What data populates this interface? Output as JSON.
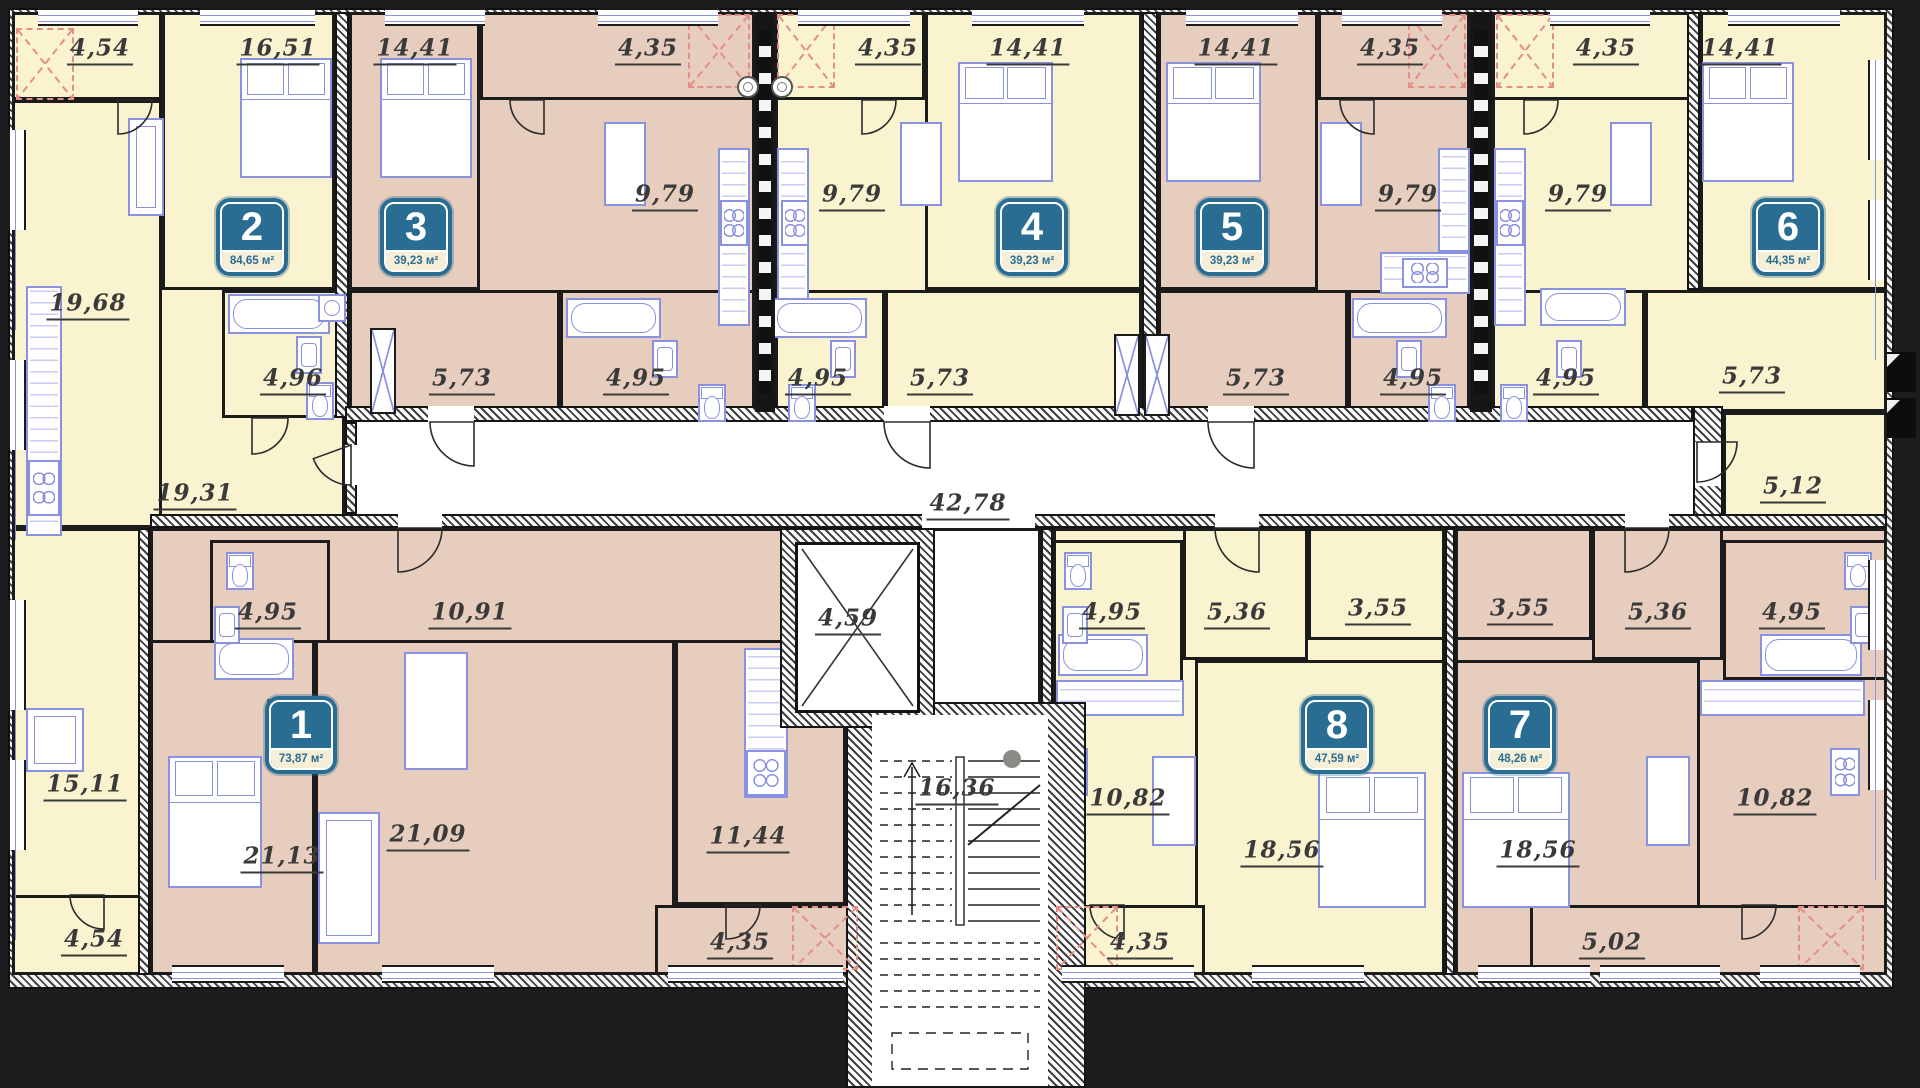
{
  "title": "Residential floor plan, 8 apartments",
  "palette": {
    "yellow": "#faf3cf",
    "pink": "#e7cdbe",
    "white": "#ffffff",
    "badge_teal": "#2a6d92",
    "badge_strip": "#f6efd7",
    "label_ink": "#3a3a3a",
    "furniture_blue": "#8a92e0",
    "balcony_red": "#e29087",
    "background": "#1d1d1f"
  },
  "units_suffix": "м²",
  "apartments": [
    {
      "n": "1",
      "area": "73,87 м²",
      "cx": 301,
      "cy": 735
    },
    {
      "n": "2",
      "area": "84,65 м²",
      "cx": 252,
      "cy": 237
    },
    {
      "n": "3",
      "area": "39,23 м²",
      "cx": 416,
      "cy": 237
    },
    {
      "n": "4",
      "area": "39,23 м²",
      "cx": 1032,
      "cy": 237
    },
    {
      "n": "5",
      "area": "39,23 м²",
      "cx": 1232,
      "cy": 237
    },
    {
      "n": "6",
      "area": "44,35 м²",
      "cx": 1788,
      "cy": 237
    },
    {
      "n": "7",
      "area": "48,26 м²",
      "cx": 1520,
      "cy": 735
    },
    {
      "n": "8",
      "area": "47,59 м²",
      "cx": 1337,
      "cy": 735
    }
  ],
  "structure": {
    "footprint": {
      "x": 8,
      "y": 8,
      "w": 1886,
      "h": 981
    },
    "interior": {
      "x": 24,
      "y": 24,
      "w": 1854,
      "h": 951
    },
    "stair_tower": {
      "x": 846,
      "y": 702,
      "w": 240,
      "h": 386
    },
    "stair_inner": {
      "x": 872,
      "y": 715,
      "w": 176,
      "h": 371
    },
    "elevator": {
      "label": "4,59",
      "x": 795,
      "y": 528,
      "w": 125,
      "h": 185,
      "lx": 848,
      "ly": 620
    },
    "stairs_label": {
      "text": "16,36",
      "lx": 957,
      "ly": 790
    },
    "corridor_label": {
      "text": "42,78",
      "lx": 968,
      "ly": 505
    }
  },
  "rooms": [
    {
      "f": "y",
      "x": 12,
      "y": 12,
      "w": 333,
      "h": 516
    },
    {
      "f": "y",
      "x": 12,
      "y": 12,
      "w": 150,
      "h": 88,
      "label": "4,54",
      "lx": 100,
      "ly": 50
    },
    {
      "f": "y",
      "x": 12,
      "y": 100,
      "w": 150,
      "h": 428,
      "label": "19,68",
      "lx": 88,
      "ly": 305
    },
    {
      "f": "y",
      "x": 162,
      "y": 12,
      "w": 173,
      "h": 278,
      "label": "16,51",
      "lx": 278,
      "ly": 50
    },
    {
      "f": "y",
      "x": 222,
      "y": 290,
      "w": 123,
      "h": 128,
      "label": "4,96",
      "lx": 293,
      "ly": 380
    },
    {
      "label": "19,31",
      "lx": 195,
      "ly": 495
    },
    {
      "f": "p",
      "x": 349,
      "y": 12,
      "w": 406,
      "h": 408
    },
    {
      "f": "p",
      "x": 349,
      "y": 12,
      "w": 131,
      "h": 278,
      "label": "14,41",
      "lx": 415,
      "ly": 50
    },
    {
      "f": "p",
      "x": 480,
      "y": 12,
      "w": 275,
      "h": 88,
      "label": "4,35",
      "lx": 648,
      "ly": 50
    },
    {
      "label": "9,79",
      "lx": 665,
      "ly": 196
    },
    {
      "f": "p",
      "x": 349,
      "y": 290,
      "w": 211,
      "h": 128,
      "label": "5,73",
      "lx": 462,
      "ly": 380
    },
    {
      "f": "p",
      "x": 560,
      "y": 290,
      "w": 195,
      "h": 128,
      "label": "4,95",
      "lx": 636,
      "ly": 380
    },
    {
      "f": "y",
      "x": 775,
      "y": 12,
      "w": 367,
      "h": 408
    },
    {
      "f": "y",
      "x": 775,
      "y": 12,
      "w": 150,
      "h": 88,
      "label": "4,35",
      "lx": 888,
      "ly": 50
    },
    {
      "f": "y",
      "x": 925,
      "y": 12,
      "w": 217,
      "h": 278,
      "label": "14,41",
      "lx": 1028,
      "ly": 50
    },
    {
      "label": "9,79",
      "lx": 852,
      "ly": 196
    },
    {
      "f": "y",
      "x": 775,
      "y": 290,
      "w": 110,
      "h": 128,
      "label": "4,95",
      "lx": 818,
      "ly": 380
    },
    {
      "f": "y",
      "x": 885,
      "y": 290,
      "w": 257,
      "h": 128,
      "label": "5,73",
      "lx": 940,
      "ly": 380
    },
    {
      "f": "p",
      "x": 1158,
      "y": 12,
      "w": 312,
      "h": 408
    },
    {
      "f": "p",
      "x": 1158,
      "y": 12,
      "w": 160,
      "h": 278,
      "label": "14,41",
      "lx": 1236,
      "ly": 50
    },
    {
      "f": "p",
      "x": 1318,
      "y": 12,
      "w": 152,
      "h": 88,
      "label": "4,35",
      "lx": 1390,
      "ly": 50
    },
    {
      "label": "9,79",
      "lx": 1408,
      "ly": 196
    },
    {
      "f": "p",
      "x": 1158,
      "y": 290,
      "w": 190,
      "h": 128,
      "label": "5,73",
      "lx": 1256,
      "ly": 380
    },
    {
      "f": "p",
      "x": 1348,
      "y": 290,
      "w": 122,
      "h": 128,
      "label": "4,95",
      "lx": 1413,
      "ly": 380
    },
    {
      "f": "y",
      "x": 1492,
      "y": 12,
      "w": 395,
      "h": 408
    },
    {
      "f": "y",
      "x": 1492,
      "y": 12,
      "w": 208,
      "h": 88,
      "label": "4,35",
      "lx": 1606,
      "ly": 50
    },
    {
      "f": "y",
      "x": 1700,
      "y": 12,
      "w": 187,
      "h": 278,
      "label": "14,41",
      "lx": 1740,
      "ly": 50
    },
    {
      "label": "9,79",
      "lx": 1578,
      "ly": 196
    },
    {
      "f": "y",
      "x": 1492,
      "y": 290,
      "w": 153,
      "h": 128,
      "label": "4,95",
      "lx": 1566,
      "ly": 380
    },
    {
      "f": "y",
      "x": 1645,
      "y": 290,
      "w": 242,
      "h": 122,
      "label": "5,73",
      "lx": 1752,
      "ly": 378
    },
    {
      "f": "y",
      "x": 1723,
      "y": 412,
      "w": 164,
      "h": 116,
      "label": "5,12",
      "lx": 1793,
      "ly": 488
    },
    {
      "f": "y",
      "x": 12,
      "y": 528,
      "w": 138,
      "h": 447
    },
    {
      "label": "15,11",
      "lx": 85,
      "ly": 786
    },
    {
      "f": "y",
      "x": 12,
      "y": 895,
      "w": 138,
      "h": 80,
      "label": "4,54",
      "lx": 94,
      "ly": 941
    },
    {
      "f": "p",
      "x": 150,
      "y": 528,
      "w": 696,
      "h": 447
    },
    {
      "f": "p",
      "x": 210,
      "y": 540,
      "w": 120,
      "h": 160,
      "label": "4,95",
      "lx": 268,
      "ly": 614
    },
    {
      "label": "10,91",
      "lx": 470,
      "ly": 614
    },
    {
      "f": "p",
      "x": 150,
      "y": 640,
      "w": 165,
      "h": 335,
      "label": "21,13",
      "lx": 282,
      "ly": 858
    },
    {
      "f": "p",
      "x": 315,
      "y": 640,
      "w": 360,
      "h": 335,
      "label": "21,09",
      "lx": 428,
      "ly": 836
    },
    {
      "f": "p",
      "x": 675,
      "y": 640,
      "w": 171,
      "h": 265,
      "label": "11,44",
      "lx": 748,
      "ly": 838
    },
    {
      "f": "p",
      "x": 655,
      "y": 905,
      "w": 205,
      "h": 70,
      "label": "4,35",
      "lx": 740,
      "ly": 944
    },
    {
      "f": "y",
      "x": 1053,
      "y": 528,
      "w": 392,
      "h": 447
    },
    {
      "f": "y",
      "x": 1053,
      "y": 540,
      "w": 130,
      "h": 160,
      "label": "4,95",
      "lx": 1112,
      "ly": 614
    },
    {
      "f": "y",
      "x": 1183,
      "y": 528,
      "w": 125,
      "h": 132,
      "label": "5,36",
      "lx": 1237,
      "ly": 614
    },
    {
      "f": "y",
      "x": 1308,
      "y": 528,
      "w": 137,
      "h": 112,
      "label": "3,55",
      "lx": 1378,
      "ly": 610
    },
    {
      "label": "10,82",
      "lx": 1128,
      "ly": 800
    },
    {
      "f": "y",
      "x": 1195,
      "y": 660,
      "w": 250,
      "h": 315,
      "label": "18,56",
      "lx": 1282,
      "ly": 852
    },
    {
      "f": "y",
      "x": 1053,
      "y": 905,
      "w": 152,
      "h": 70,
      "label": "4,35",
      "lx": 1140,
      "ly": 944
    },
    {
      "f": "p",
      "x": 1455,
      "y": 528,
      "w": 432,
      "h": 447
    },
    {
      "f": "p",
      "x": 1455,
      "y": 528,
      "w": 137,
      "h": 112,
      "label": "3,55",
      "lx": 1520,
      "ly": 610
    },
    {
      "f": "p",
      "x": 1592,
      "y": 528,
      "w": 131,
      "h": 132,
      "label": "5,36",
      "lx": 1658,
      "ly": 614
    },
    {
      "f": "p",
      "x": 1723,
      "y": 540,
      "w": 164,
      "h": 140,
      "label": "4,95",
      "lx": 1792,
      "ly": 614
    },
    {
      "label": "10,82",
      "lx": 1775,
      "ly": 800
    },
    {
      "f": "p",
      "x": 1455,
      "y": 660,
      "w": 245,
      "h": 315,
      "label": "18,56",
      "lx": 1538,
      "ly": 852
    },
    {
      "f": "p",
      "x": 1530,
      "y": 905,
      "w": 357,
      "h": 70,
      "label": "5,02",
      "lx": 1612,
      "ly": 944
    },
    {
      "f": "w",
      "x": 920,
      "y": 528,
      "w": 121,
      "h": 190
    }
  ],
  "walls": [
    {
      "x": 335,
      "y": 12,
      "w": 14,
      "h": 406
    },
    {
      "x": 1142,
      "y": 12,
      "w": 16,
      "h": 406
    },
    {
      "x": 1687,
      "y": 12,
      "w": 13,
      "h": 278
    },
    {
      "x": 345,
      "y": 406,
      "w": 1348,
      "h": 16
    },
    {
      "x": 1693,
      "y": 406,
      "w": 30,
      "h": 122
    },
    {
      "x": 345,
      "y": 422,
      "w": 12,
      "h": 92
    },
    {
      "x": 150,
      "y": 514,
      "w": 1737,
      "h": 14
    },
    {
      "x": 138,
      "y": 528,
      "w": 12,
      "h": 447
    },
    {
      "x": 1041,
      "y": 528,
      "w": 12,
      "h": 447
    },
    {
      "x": 1445,
      "y": 528,
      "w": 10,
      "h": 447
    }
  ],
  "gaps": [
    {
      "x": 428,
      "y": 406,
      "w": 46,
      "h": 16
    },
    {
      "x": 884,
      "y": 406,
      "w": 46,
      "h": 16
    },
    {
      "x": 1208,
      "y": 406,
      "w": 46,
      "h": 16
    },
    {
      "x": 1695,
      "y": 442,
      "w": 26,
      "h": 44
    },
    {
      "x": 398,
      "y": 514,
      "w": 44,
      "h": 14
    },
    {
      "x": 1215,
      "y": 514,
      "w": 44,
      "h": 14
    },
    {
      "x": 1625,
      "y": 514,
      "w": 44,
      "h": 14
    },
    {
      "x": 922,
      "y": 514,
      "w": 113,
      "h": 14
    },
    {
      "x": 920,
      "y": 700,
      "w": 115,
      "h": 17
    },
    {
      "x": 345,
      "y": 445,
      "w": 12,
      "h": 40
    }
  ],
  "shafts": [
    {
      "x": 755,
      "y": 12,
      "w": 20,
      "h": 400
    },
    {
      "x": 1470,
      "y": 12,
      "w": 22,
      "h": 400
    }
  ],
  "vents": [
    {
      "x": 737,
      "y": 76
    },
    {
      "x": 771,
      "y": 76
    }
  ],
  "redboxes": [
    {
      "x": 16,
      "y": 28,
      "w": 58,
      "h": 72
    },
    {
      "x": 688,
      "y": 14,
      "w": 62,
      "h": 74
    },
    {
      "x": 777,
      "y": 14,
      "w": 58,
      "h": 74
    },
    {
      "x": 1408,
      "y": 14,
      "w": 58,
      "h": 74
    },
    {
      "x": 1496,
      "y": 14,
      "w": 58,
      "h": 74
    },
    {
      "x": 792,
      "y": 906,
      "w": 66,
      "h": 64
    },
    {
      "x": 1056,
      "y": 906,
      "w": 62,
      "h": 64
    },
    {
      "x": 1798,
      "y": 906,
      "w": 66,
      "h": 64
    }
  ],
  "windows_top": [
    {
      "x": 38,
      "w": 100
    },
    {
      "x": 200,
      "w": 115
    },
    {
      "x": 385,
      "w": 100
    },
    {
      "x": 598,
      "w": 120
    },
    {
      "x": 798,
      "w": 112
    },
    {
      "x": 972,
      "w": 112
    },
    {
      "x": 1186,
      "w": 112
    },
    {
      "x": 1342,
      "w": 100
    },
    {
      "x": 1550,
      "w": 100
    },
    {
      "x": 1728,
      "w": 112
    }
  ],
  "windows_bottom": [
    {
      "x": 172,
      "w": 112
    },
    {
      "x": 382,
      "w": 112
    },
    {
      "x": 668,
      "w": 175
    },
    {
      "x": 1062,
      "w": 132
    },
    {
      "x": 1252,
      "w": 112
    },
    {
      "x": 1478,
      "w": 112
    },
    {
      "x": 1600,
      "w": 120
    },
    {
      "x": 1760,
      "w": 100
    }
  ],
  "windows_left": [
    {
      "y": 130,
      "h": 100
    },
    {
      "y": 360,
      "h": 90
    },
    {
      "y": 600,
      "h": 110
    },
    {
      "y": 760,
      "h": 90
    }
  ],
  "windows_right": [
    {
      "y": 60,
      "h": 100
    },
    {
      "y": 200,
      "h": 80
    },
    {
      "y": 560,
      "h": 90
    },
    {
      "y": 700,
      "h": 90
    }
  ],
  "steps": [
    {
      "x": 1882,
      "y": 352
    },
    {
      "x": 1882,
      "y": 398
    }
  ],
  "xpanels": [
    {
      "x": 370,
      "y": 328,
      "w": 26,
      "h": 86
    },
    {
      "x": 1114,
      "y": 334,
      "w": 26,
      "h": 82
    },
    {
      "x": 1144,
      "y": 334,
      "w": 26,
      "h": 82
    }
  ],
  "furniture": {
    "beds": [
      {
        "x": 240,
        "y": 58,
        "w": 92,
        "h": 120
      },
      {
        "x": 380,
        "y": 58,
        "w": 92,
        "h": 120
      },
      {
        "x": 958,
        "y": 62,
        "w": 95,
        "h": 120
      },
      {
        "x": 1166,
        "y": 62,
        "w": 95,
        "h": 120
      },
      {
        "x": 1702,
        "y": 62,
        "w": 92,
        "h": 120
      },
      {
        "x": 168,
        "y": 756,
        "w": 94,
        "h": 132
      },
      {
        "x": 1318,
        "y": 772,
        "w": 108,
        "h": 136
      },
      {
        "x": 1462,
        "y": 772,
        "w": 108,
        "h": 136
      }
    ],
    "tubs": [
      {
        "x": 228,
        "y": 294,
        "w": 102,
        "h": 40
      },
      {
        "x": 566,
        "y": 298,
        "w": 95,
        "h": 40
      },
      {
        "x": 772,
        "y": 298,
        "w": 95,
        "h": 40
      },
      {
        "x": 1352,
        "y": 298,
        "w": 95,
        "h": 40
      },
      {
        "x": 1540,
        "y": 288,
        "w": 86,
        "h": 38
      },
      {
        "x": 214,
        "y": 638,
        "w": 80,
        "h": 42
      },
      {
        "x": 1058,
        "y": 634,
        "w": 90,
        "h": 42
      },
      {
        "x": 1760,
        "y": 634,
        "w": 102,
        "h": 42
      }
    ],
    "toilets": [
      {
        "x": 306,
        "y": 382
      },
      {
        "x": 698,
        "y": 384
      },
      {
        "x": 788,
        "y": 384
      },
      {
        "x": 1428,
        "y": 384
      },
      {
        "x": 1500,
        "y": 384
      },
      {
        "x": 226,
        "y": 552
      },
      {
        "x": 1064,
        "y": 552
      },
      {
        "x": 1844,
        "y": 552
      }
    ],
    "sinks": [
      {
        "x": 296,
        "y": 336
      },
      {
        "x": 652,
        "y": 340
      },
      {
        "x": 830,
        "y": 340
      },
      {
        "x": 1396,
        "y": 340
      },
      {
        "x": 1556,
        "y": 340
      },
      {
        "x": 214,
        "y": 606
      },
      {
        "x": 1062,
        "y": 606
      },
      {
        "x": 1850,
        "y": 606
      }
    ],
    "tables": [
      {
        "x": 604,
        "y": 122,
        "w": 42,
        "h": 84
      },
      {
        "x": 900,
        "y": 122,
        "w": 42,
        "h": 84
      },
      {
        "x": 1320,
        "y": 122,
        "w": 42,
        "h": 84
      },
      {
        "x": 1610,
        "y": 122,
        "w": 42,
        "h": 84
      },
      {
        "x": 404,
        "y": 652,
        "w": 64,
        "h": 118
      },
      {
        "x": 1152,
        "y": 756,
        "w": 44,
        "h": 90
      },
      {
        "x": 1646,
        "y": 756,
        "w": 44,
        "h": 90
      }
    ],
    "sofas": [
      {
        "x": 128,
        "y": 118,
        "w": 36,
        "h": 98
      },
      {
        "x": 318,
        "y": 812,
        "w": 62,
        "h": 132
      }
    ],
    "desks": [
      {
        "x": 26,
        "y": 708,
        "w": 58,
        "h": 64
      }
    ],
    "counters": [
      {
        "x": 26,
        "y": 286,
        "w": 36,
        "h": 250
      },
      {
        "x": 718,
        "y": 148,
        "w": 32,
        "h": 178
      },
      {
        "x": 777,
        "y": 148,
        "w": 32,
        "h": 178
      },
      {
        "x": 1380,
        "y": 252,
        "w": 90,
        "h": 42
      },
      {
        "x": 1438,
        "y": 148,
        "w": 32,
        "h": 104
      },
      {
        "x": 1494,
        "y": 148,
        "w": 32,
        "h": 178
      },
      {
        "x": 744,
        "y": 648,
        "w": 44,
        "h": 150
      },
      {
        "x": 1056,
        "y": 680,
        "w": 128,
        "h": 36
      },
      {
        "x": 1700,
        "y": 680,
        "w": 165,
        "h": 36
      }
    ],
    "stoves": [
      {
        "x": 720,
        "y": 200,
        "w": 28,
        "h": 46
      },
      {
        "x": 781,
        "y": 200,
        "w": 28,
        "h": 46
      },
      {
        "x": 1402,
        "y": 258,
        "w": 46,
        "h": 30
      },
      {
        "x": 1496,
        "y": 200,
        "w": 28,
        "h": 46
      },
      {
        "x": 28,
        "y": 460,
        "w": 32,
        "h": 56
      },
      {
        "x": 746,
        "y": 750,
        "w": 40,
        "h": 46
      },
      {
        "x": 1058,
        "y": 748,
        "w": 30,
        "h": 48
      },
      {
        "x": 1830,
        "y": 748,
        "w": 30,
        "h": 48
      }
    ],
    "washers": [
      {
        "x": 318,
        "y": 294,
        "w": 28,
        "h": 28
      }
    ]
  },
  "doors": [
    {
      "hx": 474,
      "hy": 422,
      "r": 44,
      "a0": 90,
      "a1": 180
    },
    {
      "hx": 930,
      "hy": 422,
      "r": 46,
      "a0": 90,
      "a1": 180
    },
    {
      "hx": 1254,
      "hy": 422,
      "r": 46,
      "a0": 90,
      "a1": 180
    },
    {
      "hx": 1697,
      "hy": 442,
      "r": 40,
      "a0": 0,
      "a1": 90
    },
    {
      "hx": 398,
      "hy": 528,
      "r": 44,
      "a0": 0,
      "a1": 90
    },
    {
      "hx": 1259,
      "hy": 528,
      "r": 44,
      "a0": 90,
      "a1": 180
    },
    {
      "hx": 1625,
      "hy": 528,
      "r": 44,
      "a0": 0,
      "a1": 90
    },
    {
      "hx": 252,
      "hy": 418,
      "r": 36,
      "a0": 0,
      "a1": 90
    },
    {
      "hx": 544,
      "hy": 100,
      "r": 34,
      "a0": 90,
      "a1": 180
    },
    {
      "hx": 862,
      "hy": 100,
      "r": 34,
      "a0": 0,
      "a1": 90
    },
    {
      "hx": 1374,
      "hy": 100,
      "r": 34,
      "a0": 90,
      "a1": 180
    },
    {
      "hx": 1524,
      "hy": 100,
      "r": 34,
      "a0": 0,
      "a1": 90
    },
    {
      "hx": 726,
      "hy": 905,
      "r": 34,
      "a0": 0,
      "a1": 90
    },
    {
      "hx": 1124,
      "hy": 905,
      "r": 34,
      "a0": 90,
      "a1": 180
    },
    {
      "hx": 1742,
      "hy": 905,
      "r": 34,
      "a0": 0,
      "a1": 90
    },
    {
      "hx": 118,
      "hy": 100,
      "r": 34,
      "a0": 0,
      "a1": 90
    },
    {
      "hx": 104,
      "hy": 895,
      "r": 34,
      "a0": 90,
      "a1": 180
    },
    {
      "hx": 268,
      "hy": 700,
      "r": 38,
      "a0": 0,
      "a1": 90
    },
    {
      "hx": 351,
      "hy": 445,
      "r": 40,
      "a0": 90,
      "a1": 160
    }
  ]
}
